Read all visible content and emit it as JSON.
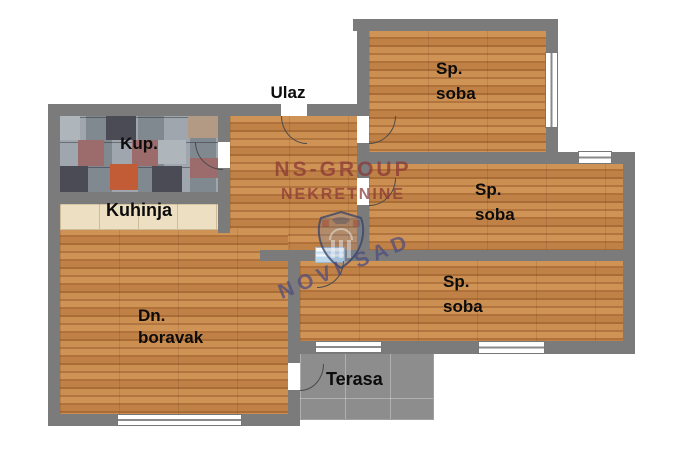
{
  "rooms": {
    "entrance": {
      "label": "Ulaz"
    },
    "bathroom": {
      "label": "Kup."
    },
    "kitchen": {
      "label": "Kuhinja"
    },
    "living_room": {
      "line1": "Dn.",
      "line2": "boravak"
    },
    "bedroom": {
      "line1": "Sp.",
      "line2": "soba"
    },
    "terrace": {
      "label": "Terasa"
    }
  },
  "watermark": {
    "brand_line1": "NS-GROUP",
    "brand_line2": "NEKRETNINE",
    "city": "NOVI SAD"
  },
  "palette": {
    "wall": "#7b7b7b",
    "wood": "#bd8045",
    "terrace": "#8d8d8d",
    "kitchen_tile": "#ecdfc2",
    "bath_base": "#8f97a0",
    "door_glass": "#bcd8ea",
    "wm_red": "#8a3636",
    "wm_blue": "#4c4c80"
  }
}
